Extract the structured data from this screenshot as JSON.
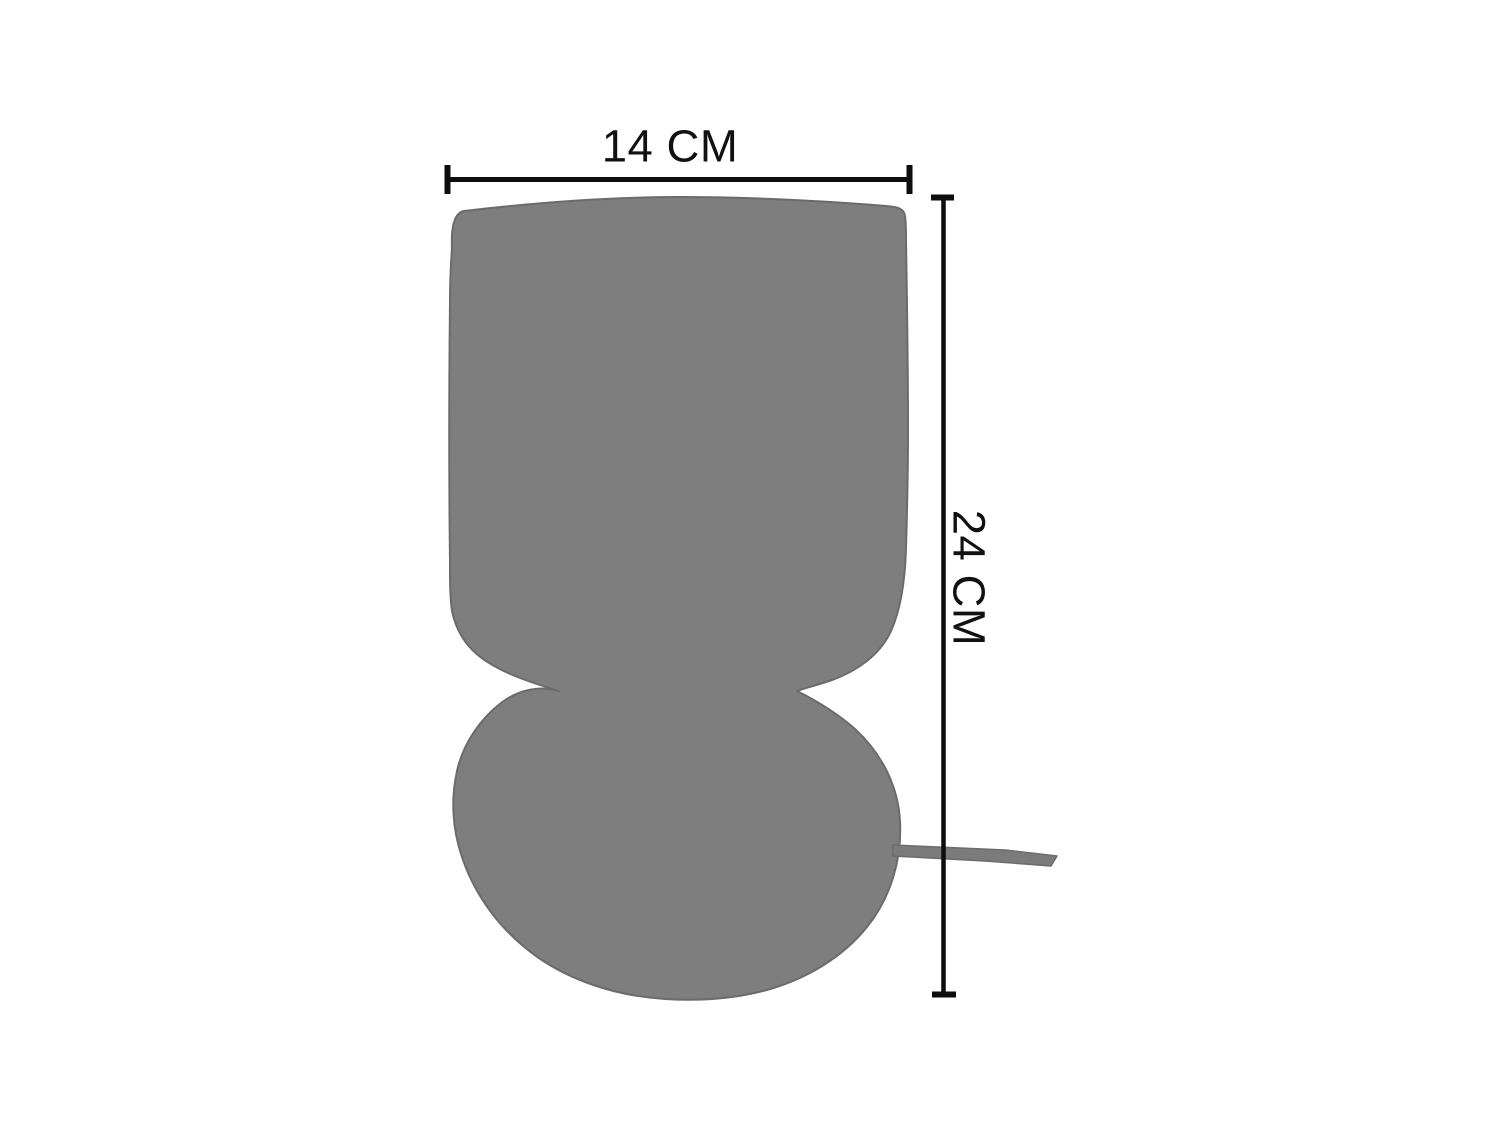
{
  "diagram": {
    "kind": "product-dimension-diagram",
    "product_shape": "table-lamp-silhouette",
    "dimensions": {
      "width_label": "14 CM",
      "height_label": "24 CM",
      "width_value_cm": 14,
      "height_value_cm": 24
    },
    "colors": {
      "silhouette": "#7e7e7e",
      "silhouette_outline": "#6b6b6b",
      "cord": "#7b7b7b",
      "cord_outline": "#6c6c6c",
      "dimension_line": "#0d0d0d",
      "label_text": "#111111",
      "background": "#ffffff"
    }
  }
}
